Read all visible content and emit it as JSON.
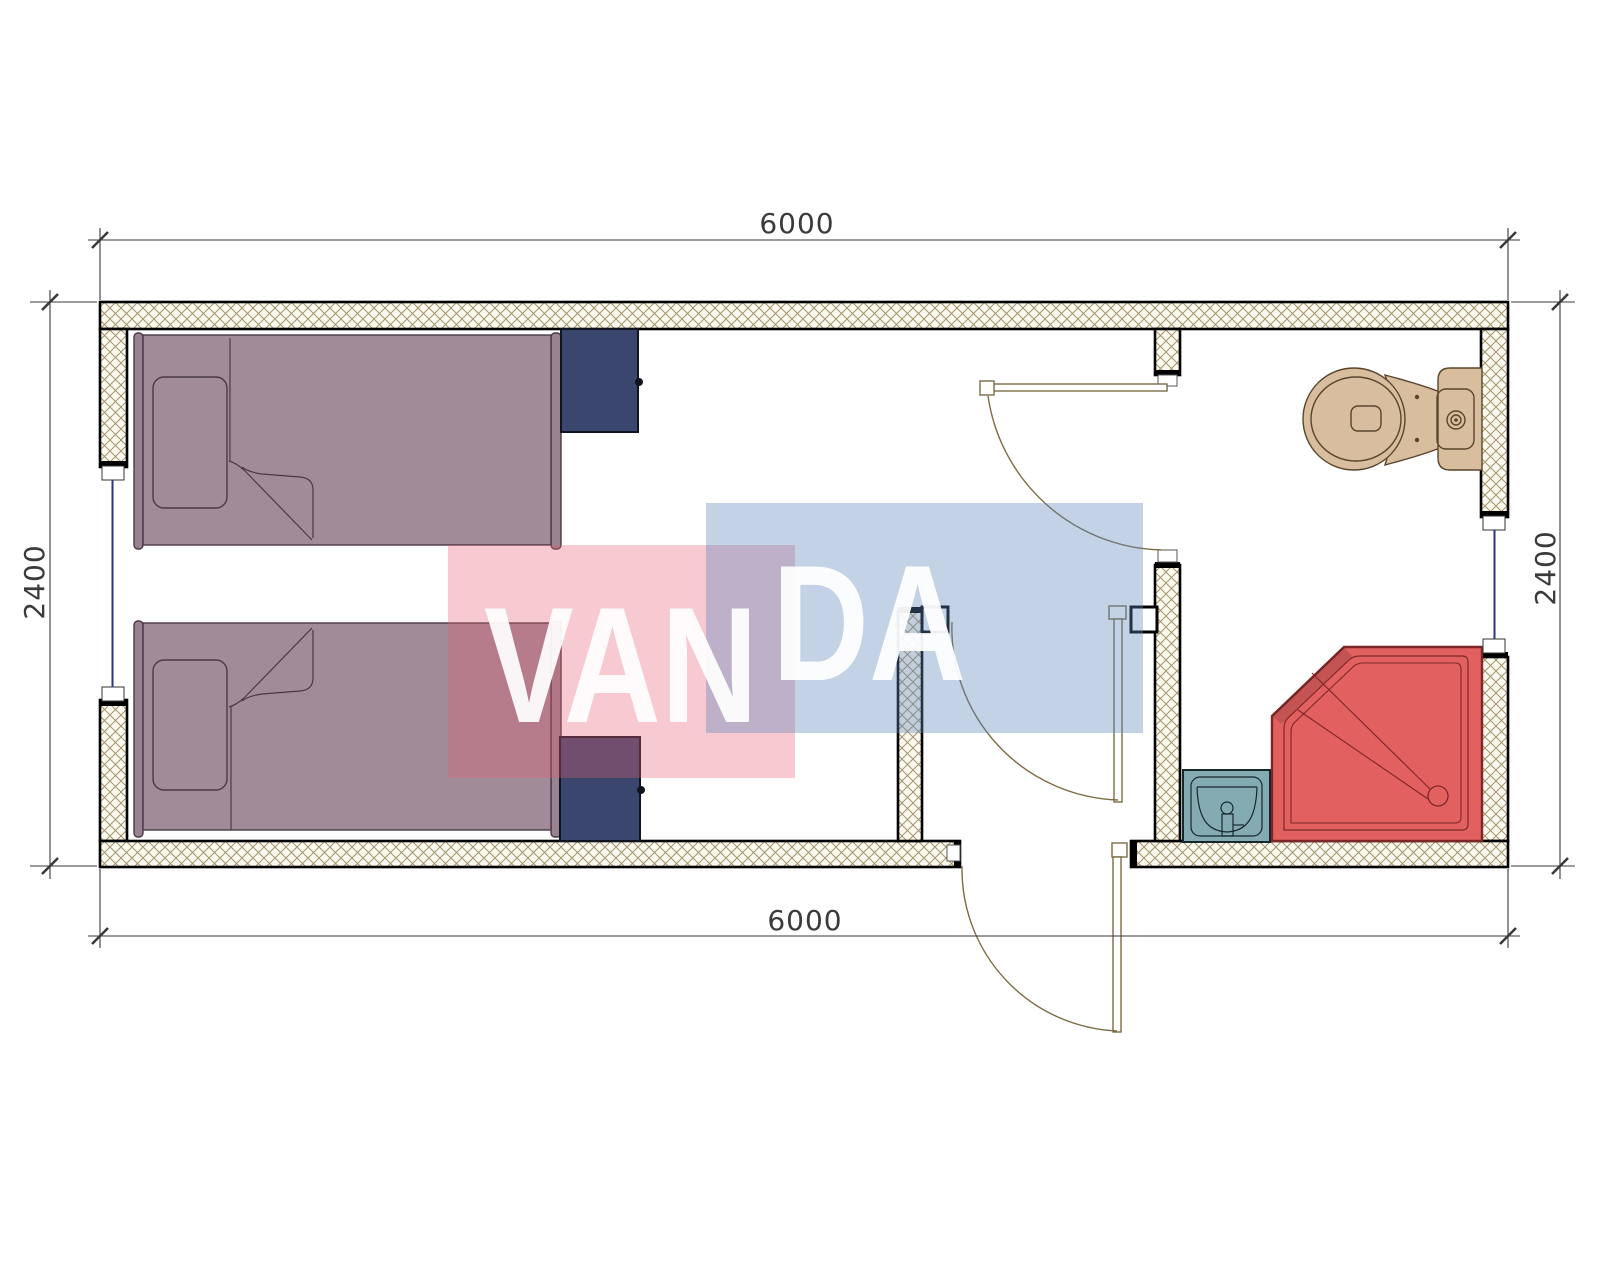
{
  "drawing": {
    "type": "floor-plan",
    "unit_width_mm": "6000",
    "unit_depth_mm": "2400"
  },
  "dimensions": {
    "top": "6000",
    "bottom": "6000",
    "left": "2400",
    "right": "2400"
  },
  "watermark": {
    "part1": "VAN",
    "part2": "DA",
    "pink_fill": "rgba(227,94,112,0.33)",
    "blue_fill": "rgba(95,132,186,0.37)",
    "text_fill": "rgba(255,255,255,0.93)"
  },
  "colors": {
    "wall_fill": "#fcf9ef",
    "hatch_line": "#a3946e",
    "wall_outline": "#000000",
    "bed": "#a28b99",
    "bed_frame": "#9a8391",
    "bed_outline": "#4a3945",
    "cabinet": "#3a466e",
    "cabinet_outline": "#10141f",
    "toilet": "#d8bd9e",
    "toilet_outline": "#5a452c",
    "shower": "#e26060",
    "shower_outline": "#7e2727",
    "sink": "#84aab2",
    "sink_outline": "#16282e",
    "window": "#2b3580",
    "door": "#7b6d46",
    "dim": "#3a3a3a"
  }
}
